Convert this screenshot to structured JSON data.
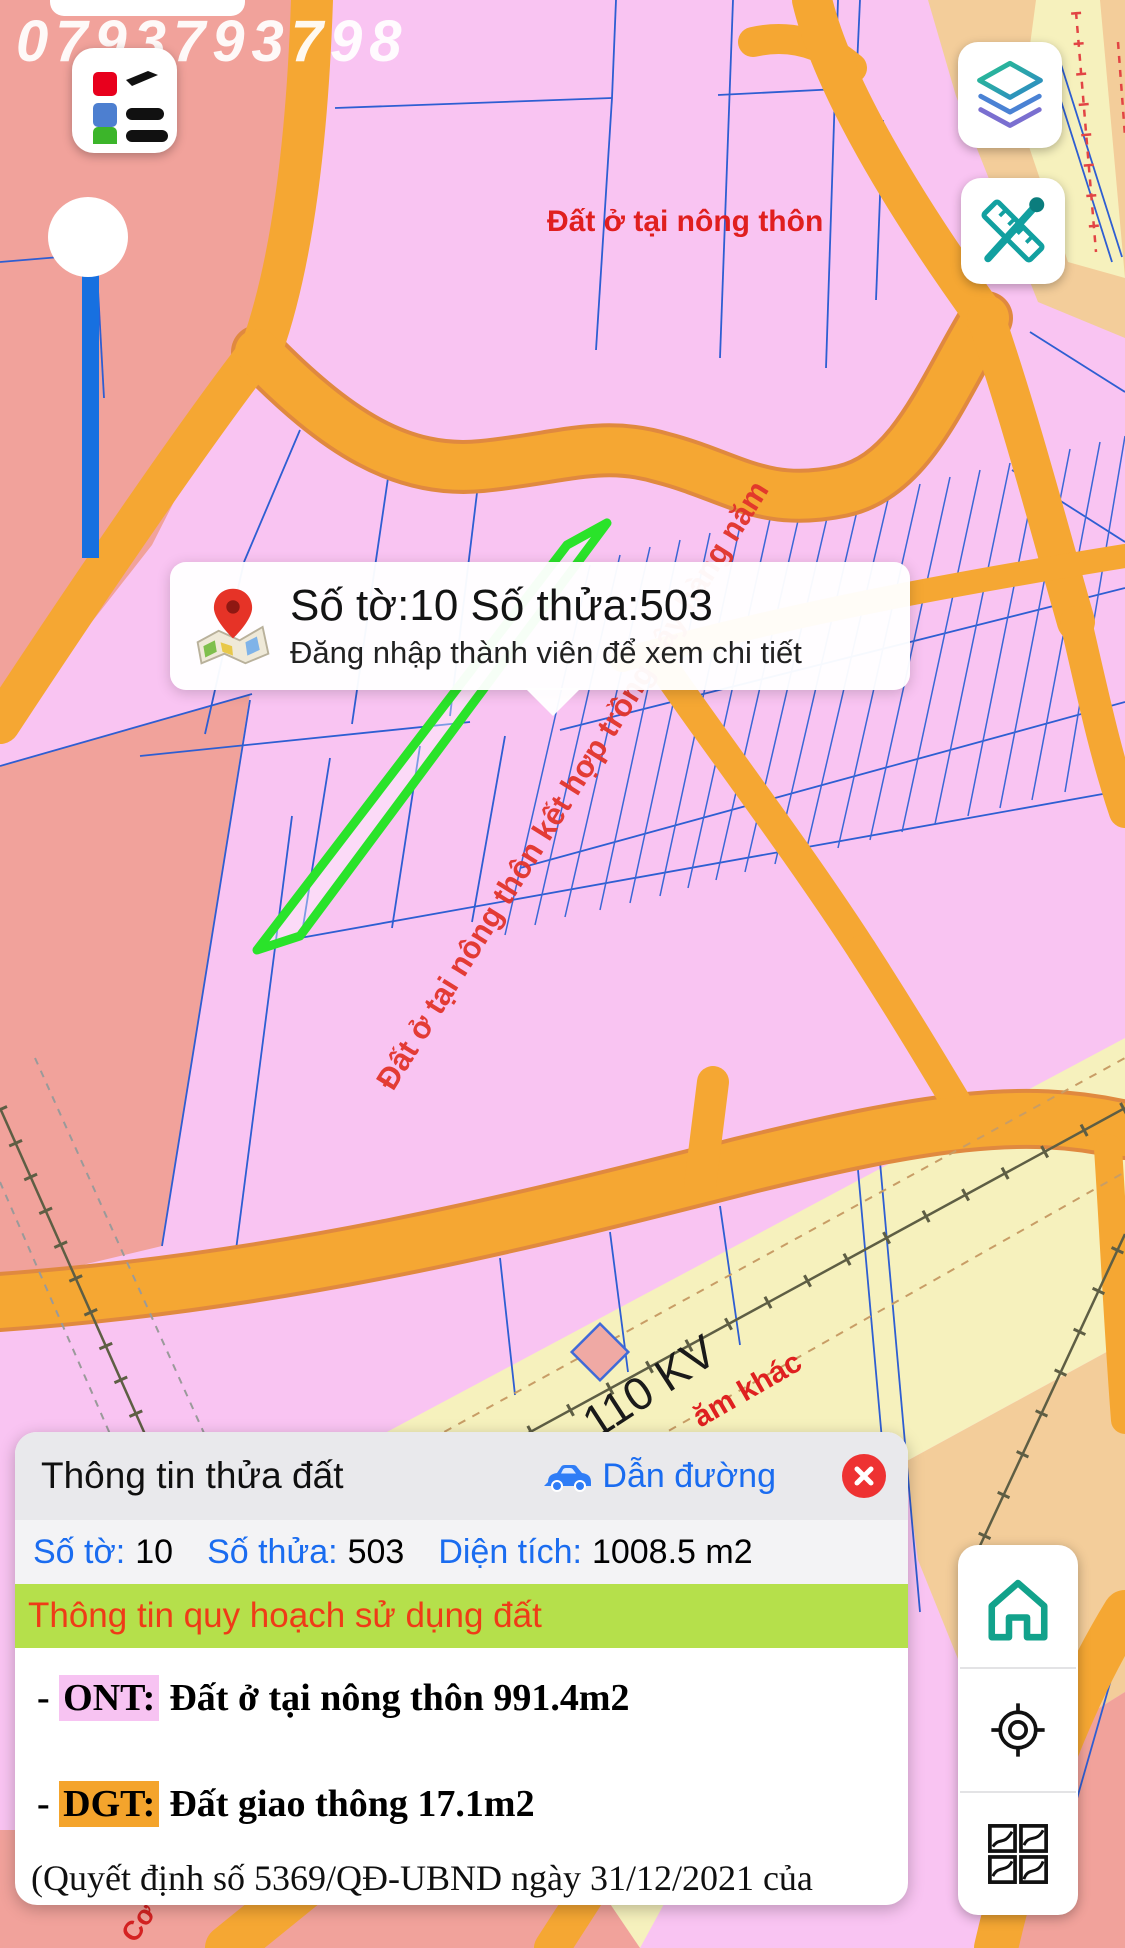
{
  "watermark": "0793793798",
  "map_labels": {
    "zone_top": "Đất ở tại nông thôn",
    "zone_diagonal": "Đất ở tại nông thôn kết hợp trồng cây hàng năm",
    "power_line": "110 KV",
    "zone_partial_right": "ăm khác",
    "zone_partial_bottom": "Cơ"
  },
  "tooltip": {
    "icon": "map-pin-icon",
    "title": "Số tờ:10 Số thửa:503",
    "subtitle": "Đăng nhập thành viên để xem chi tiết"
  },
  "panel": {
    "title": "Thông tin thửa đất",
    "directions": {
      "icon": "car-icon",
      "label": "Dẫn đường"
    },
    "close_icon": "close-icon",
    "fields": [
      {
        "label": "Số tờ:",
        "value": "10"
      },
      {
        "label": "Số thửa:",
        "value": "503"
      },
      {
        "label": "Diện tích:",
        "value": "1008.5 m2"
      }
    ],
    "section_title": "Thông tin quy hoạch sử dụng đất",
    "zoning": [
      {
        "bullet": "- ",
        "code": "ONT:",
        "text": "Đất ở tại nông thôn 991.4m2"
      },
      {
        "bullet": "- ",
        "code": "DGT:",
        "text": "Đất giao thông 17.1m2"
      }
    ],
    "note_line1": "(Quyết định số 5369/QĐ-UBND ngày 31/12/2021 của",
    "note_line2": "UBND tỉnh Đồng Nai về việc phê duyệt quy hoạch sử dụng đất"
  },
  "controls": {
    "legend_button": "legend-icon",
    "layers_button": "layers-icon",
    "measure_button": "measure-icon",
    "home_button": "home-icon",
    "locate_button": "locate-icon",
    "sheets_button": "map-sheets-icon"
  },
  "colors": {
    "accent_blue": "#1a6cf0",
    "section_green_bg": "#b5e04b",
    "section_red_text": "#ef3b17",
    "ont_highlight": "#f7c3f2",
    "dgt_highlight": "#f4a42c",
    "close_red": "#ee3232",
    "road_orange": "#f5a733",
    "parcel_pink": "#f9c4f2",
    "zone_salmon": "#f1a29b",
    "zone_yellow": "#f6f1bd",
    "zone_tan": "#f3cd9a",
    "boundary_blue": "#2e5ed2",
    "selection_green": "#2ae32a",
    "home_teal": "#12a28b"
  }
}
